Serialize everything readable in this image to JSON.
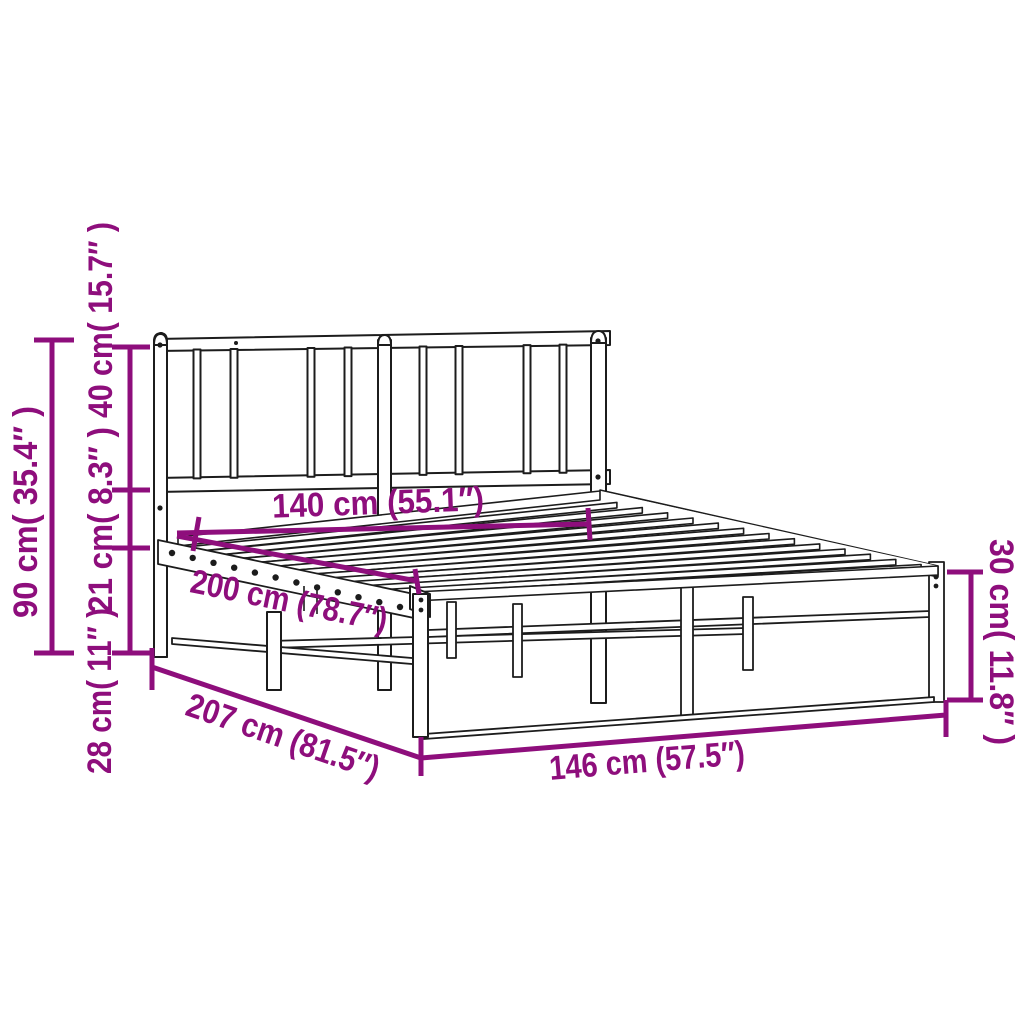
{
  "colors": {
    "annotation": "#8e0e7c",
    "ink": "#1c1c1c",
    "surface": "#ffffff"
  },
  "illustration": {
    "subject": "metal-bed-frame-with-headboard-line-drawing"
  },
  "dimensions": {
    "total_height": "90 cm( 35.4″ )",
    "headboard_height": "40 cm( 15.7″ )",
    "rail_to_headboard": "21 cm( 8.3″ )",
    "floor_to_rail": "28 cm( 11″ )",
    "mattress_width": "140 cm (55.1″)",
    "mattress_length": "200 cm (78.7″)",
    "frame_length": "207 cm (81.5″)",
    "frame_width": "146 cm (57.5″)",
    "platform_height": "30 cm( 11.8″ )"
  }
}
